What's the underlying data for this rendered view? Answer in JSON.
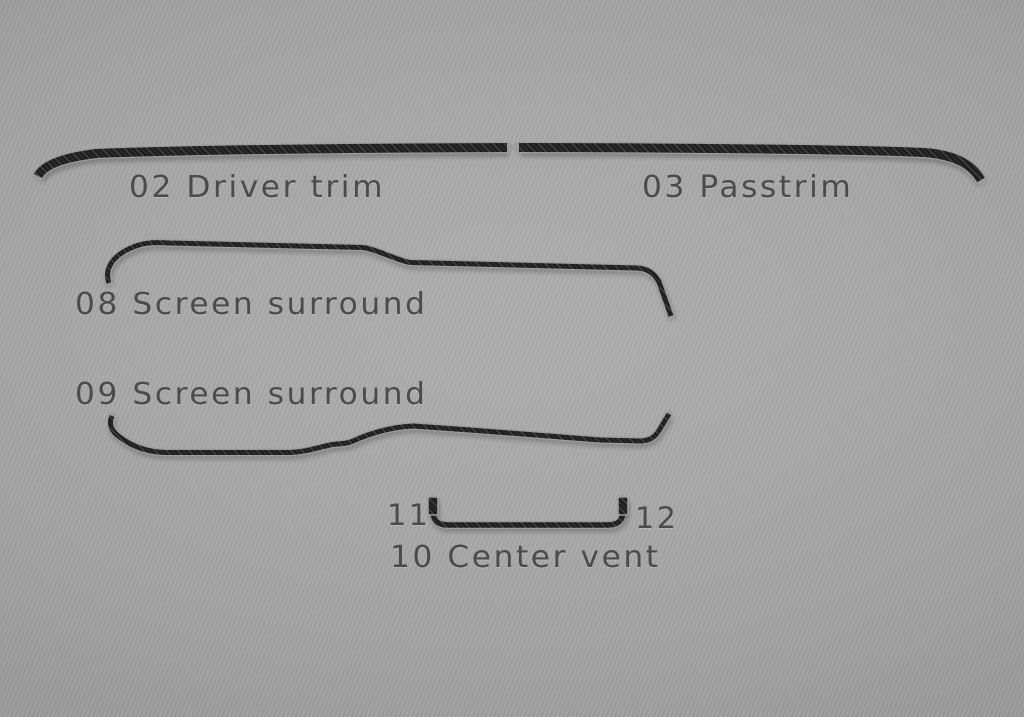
{
  "pieces": {
    "driver_trim": {
      "label": "02 Driver trim"
    },
    "passtrim": {
      "label": "03 Passtrim"
    },
    "screen_surround_top": {
      "label": "08 Screen surround"
    },
    "screen_surround_bottom": {
      "label": "09 Screen surround"
    },
    "center_vent": {
      "label": "10 Center vent"
    },
    "vent_tab_left": {
      "label": "11"
    },
    "vent_tab_right": {
      "label": "12"
    }
  },
  "colors": {
    "background_center": "#aeaeae",
    "background_edge": "#8a8a8a",
    "label_text": "#4b4b4b",
    "trim_carbon_dark": "#1c1c1c",
    "trim_carbon_light": "#3c3c3c",
    "trim_edge_highlight": "#9c9c9c"
  }
}
